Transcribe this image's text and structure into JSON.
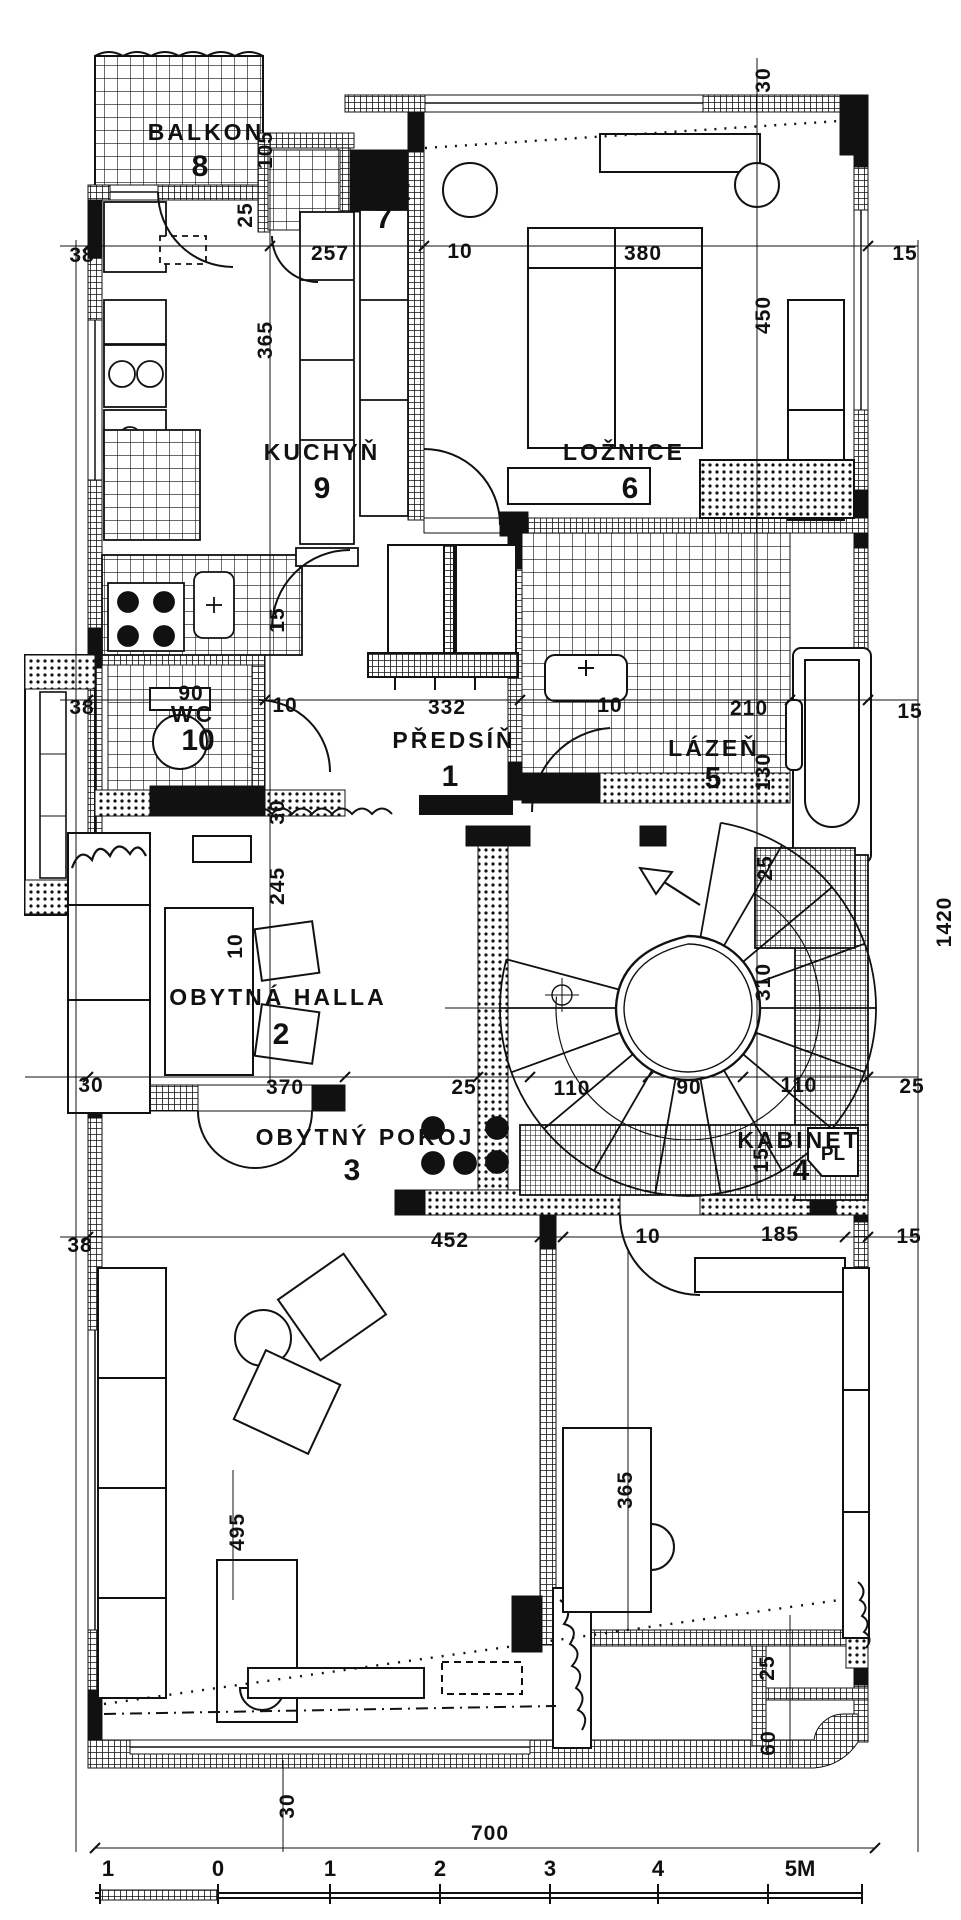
{
  "rooms": [
    {
      "name": "BALKON",
      "number": "8"
    },
    {
      "name": "SPÍŽ",
      "number": "7"
    },
    {
      "name": "KUCHYŇ",
      "number": "9"
    },
    {
      "name": "LOŽNICE",
      "number": "6"
    },
    {
      "name": "WC",
      "number": "10"
    },
    {
      "name": "PŘEDSÍŇ",
      "number": "1"
    },
    {
      "name": "LÁZEŇ",
      "number": "5"
    },
    {
      "name": "OBYTNÁ HALLA",
      "number": "2"
    },
    {
      "name": "OBYTNÝ POKOJ",
      "number": "3"
    },
    {
      "name": "KABINET",
      "number": "4"
    },
    {
      "name": "PL",
      "number": ""
    }
  ],
  "dimensions": {
    "top_row": [
      "38",
      "257",
      "10",
      "380",
      "15"
    ],
    "upper_vertical": [
      "30",
      "450",
      "105",
      "25",
      "365",
      "15"
    ],
    "mid_row": [
      "38",
      "10",
      "332",
      "10",
      "210",
      "15"
    ],
    "mid_vertical": [
      "130",
      "30",
      "245",
      "10"
    ],
    "wc_width": "90",
    "hall_row": [
      "30",
      "370",
      "25",
      "110",
      "90",
      "110",
      "25"
    ],
    "stair_vertical": [
      "25",
      "310",
      "15",
      "1420"
    ],
    "lower_row": [
      "38",
      "452",
      "10",
      "185",
      "15"
    ],
    "lower_vertical": [
      "495",
      "365",
      "25",
      "60",
      "30"
    ],
    "bottom_total": "700"
  },
  "scale_bar": {
    "labels": [
      "1",
      "0",
      "1",
      "2",
      "3",
      "4",
      "5M"
    ]
  }
}
